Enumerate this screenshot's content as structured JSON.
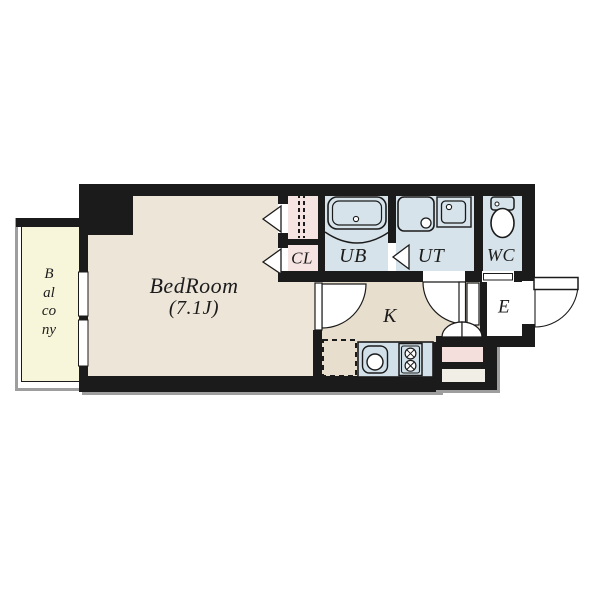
{
  "floorplan": {
    "type": "apartment-floor-plan",
    "rooms": {
      "balcony": {
        "label": "Balcony"
      },
      "bedroom": {
        "label": "BedRoom",
        "area": "(7.1J)"
      },
      "closet": {
        "label": "CL"
      },
      "unit_bath": {
        "label": "UB"
      },
      "utility": {
        "label": "UT"
      },
      "toilet": {
        "label": "WC"
      },
      "kitchen": {
        "label": "K"
      },
      "entrance": {
        "label": "E"
      }
    },
    "icons": [
      "bathtub-icon",
      "washing-machine-icon",
      "washbasin-icon",
      "toilet-icon",
      "sink-icon",
      "stove-icon",
      "refrigerator-space",
      "door-swing-arc",
      "closet-door-arrow",
      "window-symbol",
      "entrance-steps",
      "double-swing-door"
    ],
    "colors": {
      "wall": "#1b1b1b",
      "bedroom_floor": "#ece5d8",
      "kitchen_floor": "#e8decd",
      "wet_area_floor": "#d7e3ea",
      "counter": "#d2e1e9",
      "closet_floor": "#f6e4e2",
      "balcony_floor": "#f8f6da",
      "entrance_step_pink": "#f5dfdc",
      "entrance_step_white": "#f1eee6",
      "outline_shadow": "#9e9e9e"
    }
  }
}
